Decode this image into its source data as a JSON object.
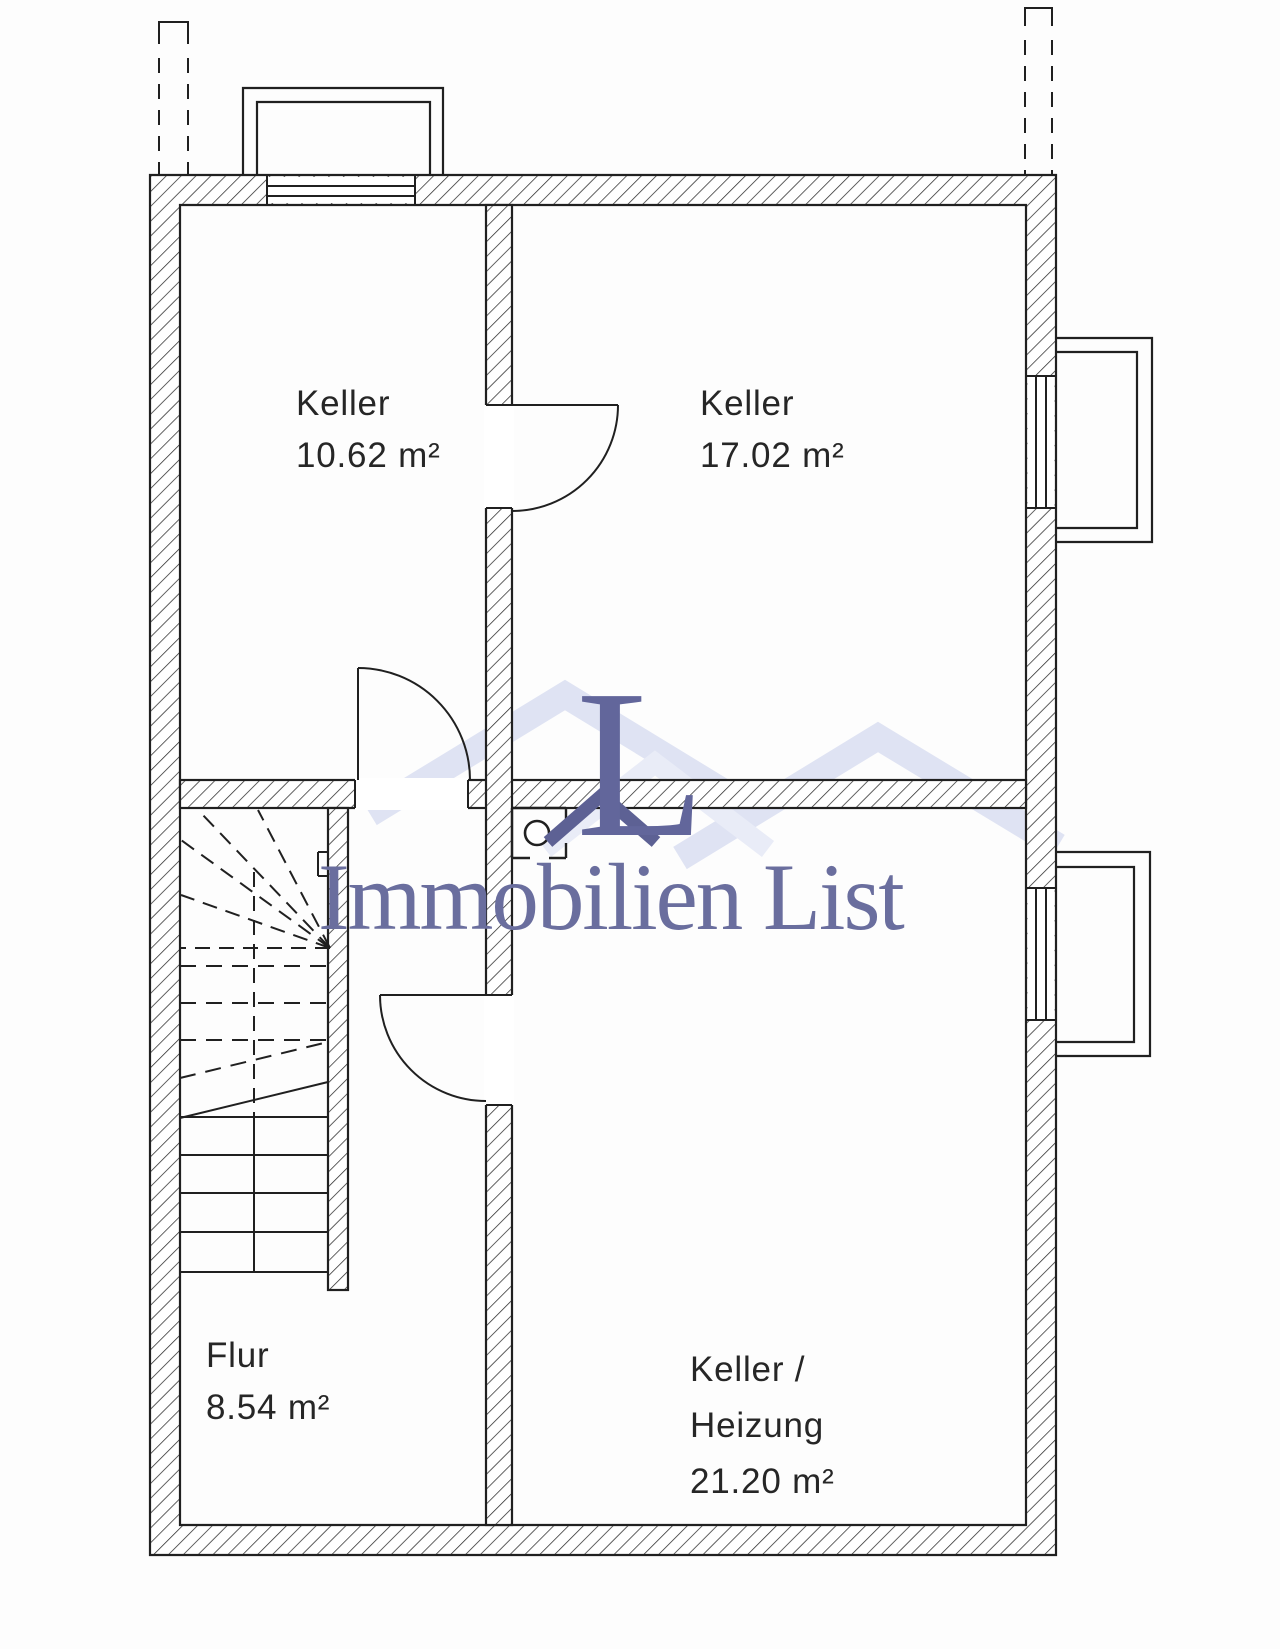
{
  "page": {
    "background": "#fdfdfd",
    "line_color": "#202020"
  },
  "rooms": [
    {
      "id": "keller-top-left",
      "label": "Keller",
      "area": "10.62 m²"
    },
    {
      "id": "keller-top-right",
      "label": "Keller",
      "area": "17.02 m²"
    },
    {
      "id": "flur",
      "label": "Flur",
      "area": "8.54 m²"
    },
    {
      "id": "keller-heizung",
      "label_line1": "Keller /",
      "label_line2": "Heizung",
      "area": "21.20 m²"
    }
  ],
  "watermark": {
    "logo_letter": "L",
    "brand_text": "Immobilien List",
    "logo_color": "#62669b",
    "text_color": "#6a6e9e",
    "roof_light_color": "#dfe3f3",
    "roof_mid_color": "#e9ecf7",
    "roof_dark_color": "#5d6194"
  },
  "symbols": {
    "chimney": "chimney-flue-symbol",
    "staircase": "basement-staircase",
    "light_well": "light-well",
    "vent_stack": "vent-stack-dashed",
    "door_swing": "door-swing-arc"
  }
}
